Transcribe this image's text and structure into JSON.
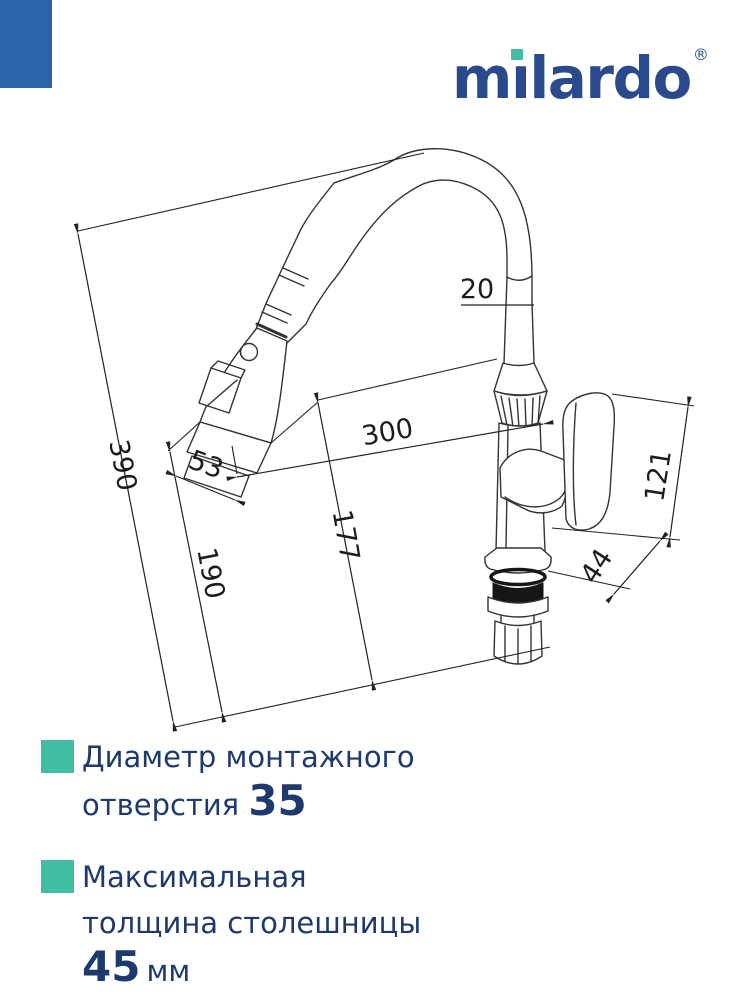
{
  "brand": {
    "logo_text": "milardo",
    "logo_prefix": "m",
    "logo_rest": "lardo",
    "registered_mark": "®"
  },
  "colors": {
    "corner_blue": "#2d64a9",
    "accent_teal": "#41bda4",
    "brand_navy": "#2a4a8c",
    "text_navy": "#1e3a6c",
    "line": "#333333"
  },
  "diagram": {
    "description": "Kitchen faucet with flexible spout and pull-out spray head, technical drawing with dimensions in mm",
    "dims": {
      "d390": "390",
      "d190": "190",
      "d177": "177",
      "d300": "300",
      "d53": "53",
      "d20": "20",
      "d121": "121",
      "d44": "44"
    }
  },
  "specs": [
    {
      "text": "Диаметр монтажного отверстия",
      "value": "35",
      "suffix": ""
    },
    {
      "text": "Максимальная толщина столешницы",
      "value": "45",
      "suffix": "мм"
    }
  ]
}
